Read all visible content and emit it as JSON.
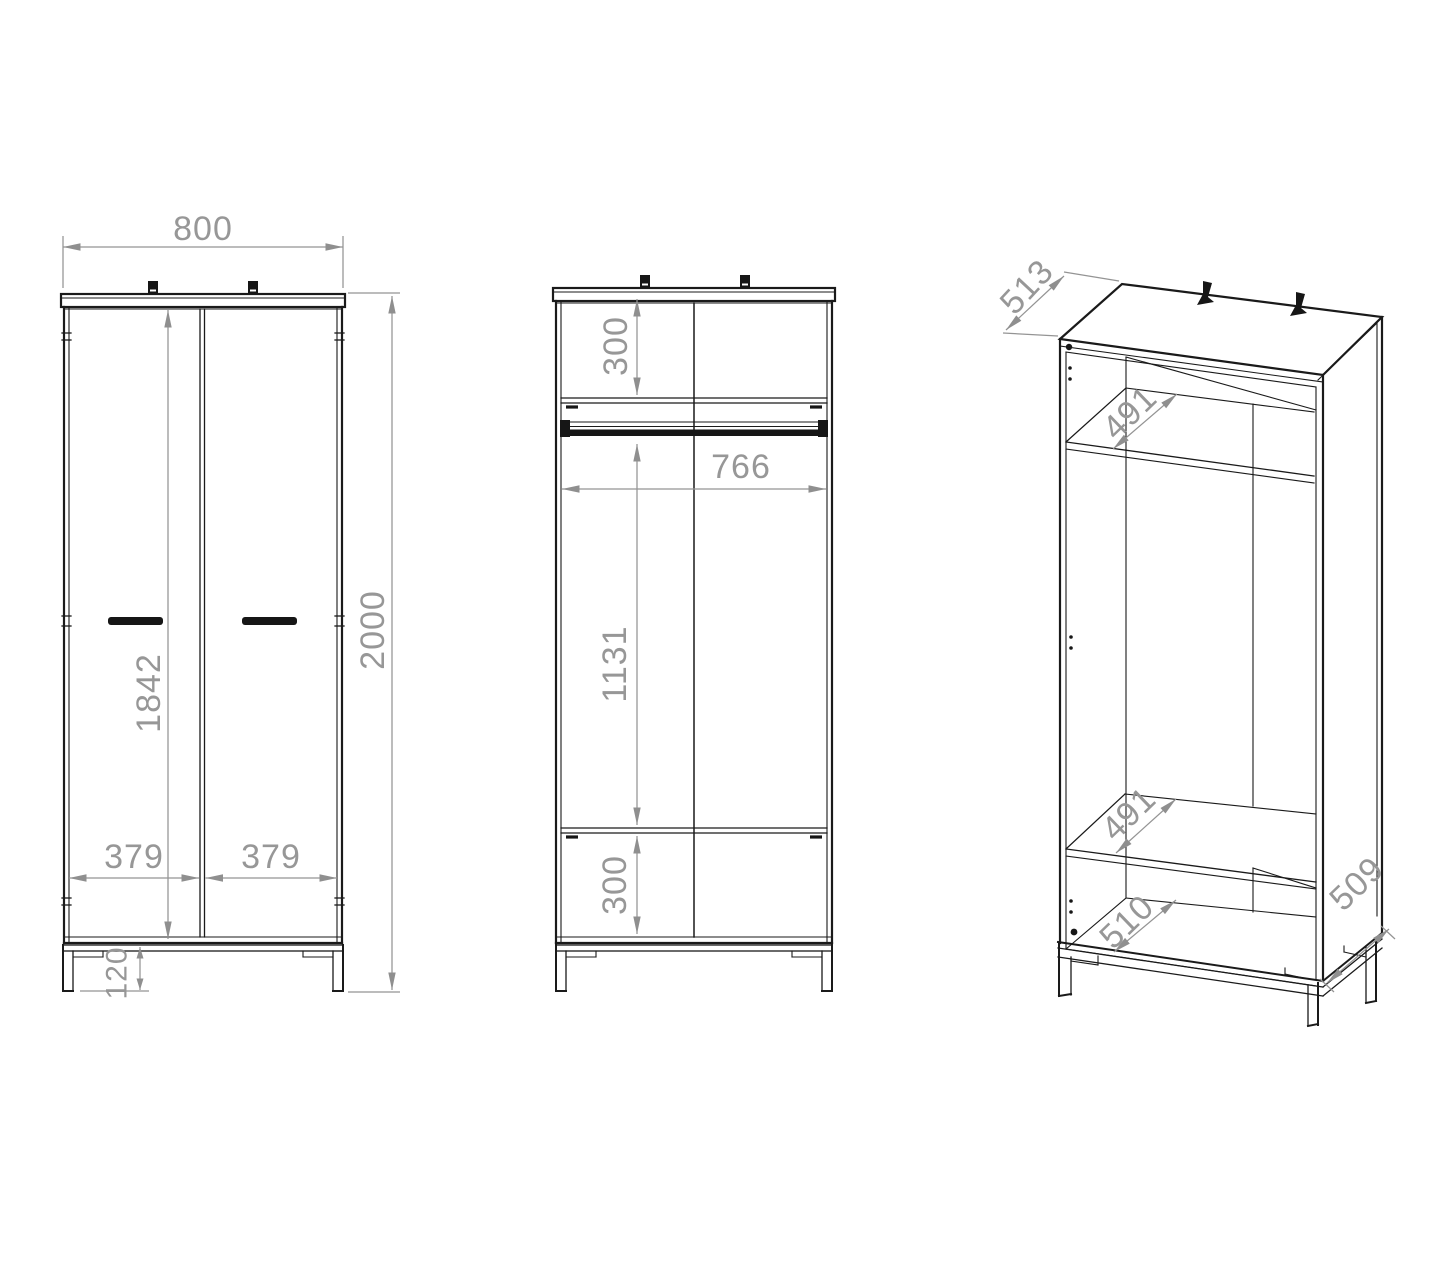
{
  "front_view": {
    "width": "800",
    "height": "2000",
    "interior_height": "1842",
    "left_door_width": "379",
    "right_door_width": "379",
    "leg_height": "120"
  },
  "section_view": {
    "top_compartment_height": "300",
    "interior_width": "766",
    "hanging_space_height": "1131",
    "bottom_compartment_height": "300"
  },
  "isometric_view": {
    "top_depth": "513",
    "top_shelf_depth": "491",
    "bottom_shelf_depth": "491",
    "bottom_panel_depth": "510",
    "side_bottom_depth": "509"
  },
  "colors": {
    "outline": "#1a1a1a",
    "dimension": "#979797"
  }
}
